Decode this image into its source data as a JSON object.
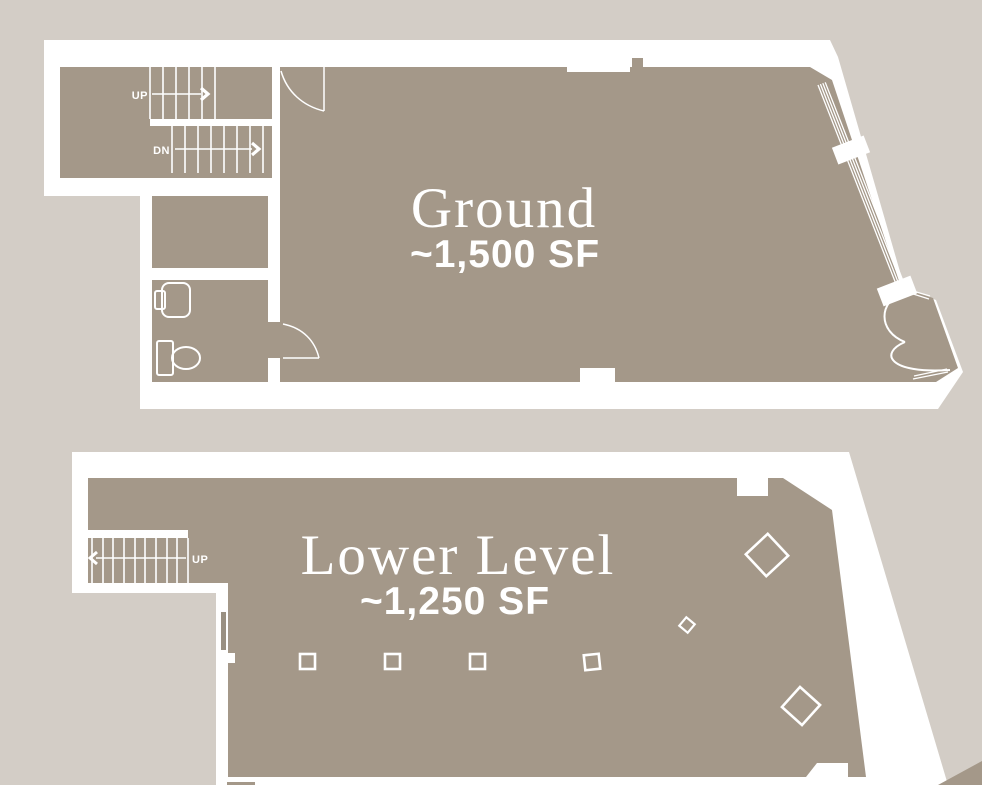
{
  "palette": {
    "background": "#d3cdc6",
    "floor": "#a49889",
    "wall": "#ffffff",
    "door_leaf_gray": "#9a9082",
    "text": "#ffffff"
  },
  "ground_floor": {
    "title": "Ground",
    "area_label": "~1,500 SF",
    "stair_up_label": "UP",
    "stair_down_label": "DN"
  },
  "lower_level": {
    "title": "Lower Level",
    "area_label": "~1,250 SF",
    "stair_up_label": "UP"
  }
}
